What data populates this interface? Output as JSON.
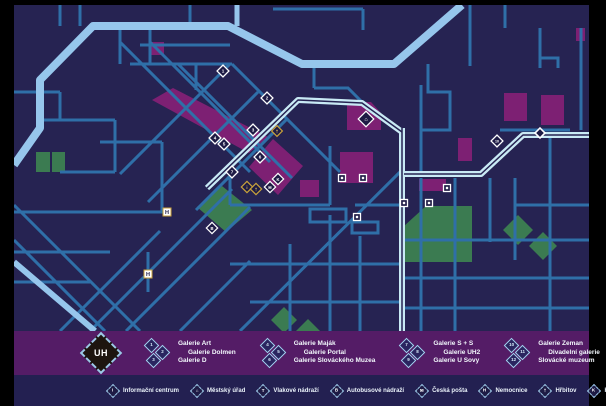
{
  "logo": {
    "text": "UH"
  },
  "legend_groups": [
    {
      "items": [
        {
          "num": "1",
          "name": "Galerie Art"
        },
        {
          "num": "2",
          "name": "Galerie Dolmen"
        },
        {
          "num": "3",
          "name": "Galerie D"
        }
      ]
    },
    {
      "items": [
        {
          "num": "4",
          "name": "Galerie Maják"
        },
        {
          "num": "5",
          "name": "Galerie Portal"
        },
        {
          "num": "6",
          "name": "Galerie Slováckého Muzea"
        }
      ]
    },
    {
      "items": [
        {
          "num": "7",
          "name": "Galerie S + S"
        },
        {
          "num": "8",
          "name": "Galerie UH2"
        },
        {
          "num": "9",
          "name": "Galerie U Sovy"
        }
      ]
    },
    {
      "items": [
        {
          "num": "10",
          "name": "Galerie Zeman"
        },
        {
          "num": "11",
          "name": "Divadelní galerie"
        },
        {
          "num": "12",
          "name": "Slovácké muzeum"
        }
      ]
    }
  ],
  "amenities": [
    {
      "icon": "info-icon",
      "glyph": "i",
      "label": "Informační centrum"
    },
    {
      "icon": "town-hall-icon",
      "glyph": "⌂",
      "label": "Městský úřad"
    },
    {
      "icon": "train-station-icon",
      "glyph": "T",
      "label": "Vlakové nádraží"
    },
    {
      "icon": "bus-station-icon",
      "glyph": "B",
      "label": "Autobusové nádraží"
    },
    {
      "icon": "post-office-icon",
      "glyph": "✉",
      "label": "Česká pošta"
    },
    {
      "icon": "hospital-icon",
      "glyph": "H",
      "label": "Nemocnice"
    },
    {
      "icon": "cemetery-icon",
      "glyph": "†",
      "label": "Hřbitov"
    },
    {
      "icon": "cinema-icon",
      "glyph": "K",
      "label": "Kino"
    }
  ],
  "map_markers": {
    "galleries": [
      {
        "num": "1",
        "x": 223,
        "y": 71
      },
      {
        "num": "2",
        "x": 267,
        "y": 98
      },
      {
        "num": "3",
        "x": 253,
        "y": 130
      },
      {
        "num": "4",
        "x": 215,
        "y": 138
      },
      {
        "num": "5",
        "x": 224,
        "y": 144
      },
      {
        "num": "6",
        "x": 260,
        "y": 157
      },
      {
        "num": "7",
        "x": 232,
        "y": 172
      },
      {
        "num": "10",
        "x": 497,
        "y": 141
      }
    ],
    "amenity_points": [
      {
        "glyph": "i",
        "x": 247,
        "y": 187,
        "gold": true
      },
      {
        "glyph": "†",
        "x": 256,
        "y": 189,
        "gold": true
      },
      {
        "glyph": "✉",
        "x": 270,
        "y": 187,
        "gold": false
      },
      {
        "glyph": "K",
        "x": 278,
        "y": 179,
        "gold": false
      },
      {
        "glyph": "⌂",
        "x": 366,
        "y": 119,
        "gold": false,
        "big": true
      },
      {
        "glyph": "B",
        "x": 212,
        "y": 228,
        "gold": false
      }
    ],
    "churches": [
      {
        "x": 277,
        "y": 131
      }
    ],
    "hospitals": [
      {
        "x": 167,
        "y": 212
      },
      {
        "x": 148,
        "y": 274
      }
    ],
    "squares": [
      {
        "x": 342,
        "y": 178
      },
      {
        "x": 363,
        "y": 178
      },
      {
        "x": 357,
        "y": 217
      },
      {
        "x": 404,
        "y": 203
      },
      {
        "x": 447,
        "y": 188
      },
      {
        "x": 429,
        "y": 203
      }
    ],
    "road_nodes": [
      {
        "x": 540,
        "y": 133
      }
    ]
  },
  "colors": {
    "frame_black": "#000000",
    "map_background": "#262352",
    "street_blue": "#2F6FA8",
    "major_road_blue": "#96C6EC",
    "river_cyan": "#C9EAF5",
    "building_purple": "#7D2073",
    "park_green": "#3B7B51",
    "legend_band_purple": "#541C66",
    "info_band_navy": "#232051",
    "marker_dark": "#1E1B45",
    "marker_gold": "#C9A23B",
    "text_white": "#FFFFFF"
  }
}
